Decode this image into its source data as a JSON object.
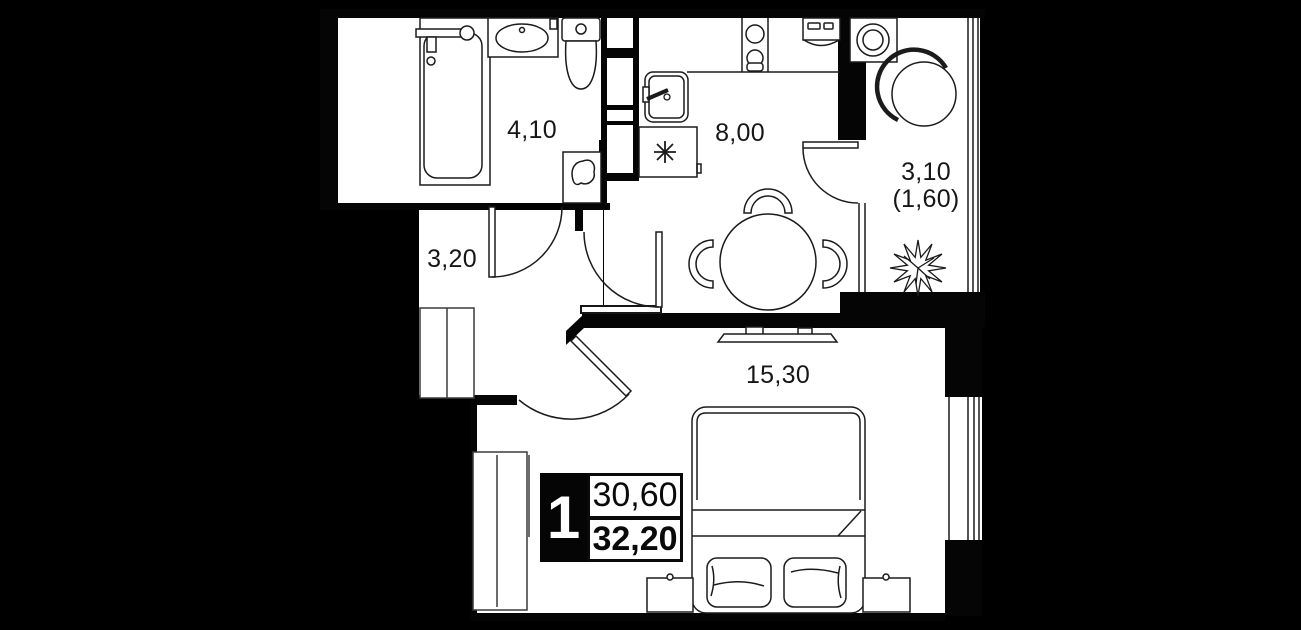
{
  "plan": {
    "colors": {
      "background": "#000000",
      "floor": "#ffffff",
      "line": "#1b1b1b"
    },
    "rooms": {
      "bathroom": {
        "area": "4,10"
      },
      "hallway": {
        "area": "3,20"
      },
      "kitchen": {
        "area": "8,00"
      },
      "balcony": {
        "area": "3,10",
        "area_reduced": "(1,60)"
      },
      "living": {
        "area": "15,30"
      }
    },
    "info_badge": {
      "rooms_count": "1",
      "living_area": "30,60",
      "total_area": "32,20"
    },
    "symbols": {
      "refrigerator": "snowflake-asterisk",
      "washing-machine": "square-with-drum-circles",
      "plant": "leafy-starburst",
      "water-heater": "box-with-blob",
      "stove": "two-burner-circles"
    }
  }
}
